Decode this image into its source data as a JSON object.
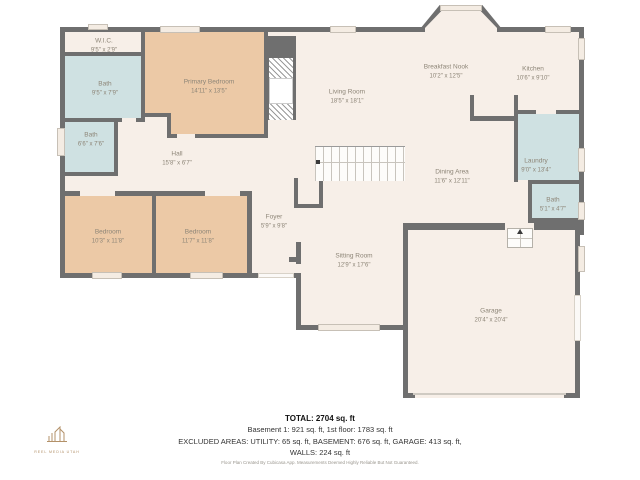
{
  "floorplan": {
    "rooms": [
      {
        "id": "wic",
        "name": "W.I.C.",
        "dims": "9'5\" x 2'9\""
      },
      {
        "id": "bath-upper",
        "name": "Bath",
        "dims": "9'5\" x 7'9\""
      },
      {
        "id": "bath-mid",
        "name": "Bath",
        "dims": "6'6\" x 7'6\""
      },
      {
        "id": "primary-bedroom",
        "name": "Primary Bedroom",
        "dims": "14'11\" x 13'5\""
      },
      {
        "id": "hall",
        "name": "Hall",
        "dims": "15'8\" x 6'7\""
      },
      {
        "id": "living-room",
        "name": "Living Room",
        "dims": "18'5\" x 18'1\""
      },
      {
        "id": "breakfast-nook",
        "name": "Breakfast Nook",
        "dims": "10'2\" x 12'5\""
      },
      {
        "id": "kitchen",
        "name": "Kitchen",
        "dims": "10'6\" x 9'10\""
      },
      {
        "id": "laundry",
        "name": "Laundry",
        "dims": "9'0\" x 13'4\""
      },
      {
        "id": "dining-area",
        "name": "Dining Area",
        "dims": "11'6\" x 12'11\""
      },
      {
        "id": "bath-small",
        "name": "Bath",
        "dims": "5'1\" x 4'7\""
      },
      {
        "id": "bedroom-left",
        "name": "Bedroom",
        "dims": "10'3\" x 11'8\""
      },
      {
        "id": "bedroom-right",
        "name": "Bedroom",
        "dims": "11'7\" x 11'8\""
      },
      {
        "id": "foyer",
        "name": "Foyer",
        "dims": "5'9\" x 9'8\""
      },
      {
        "id": "sitting-room",
        "name": "Sitting Room",
        "dims": "12'9\" x 17'6\""
      },
      {
        "id": "garage",
        "name": "Garage",
        "dims": "20'4\" x 20'4\""
      }
    ],
    "colors": {
      "wall": "#6f6f6f",
      "floor": "#f7efe8",
      "bedroom": "#ecc9a6",
      "bath": "#cfe1e2",
      "label_text": "#8d8577"
    }
  },
  "summary": {
    "total": "TOTAL: 2704 sq. ft",
    "floors": "Basement 1: 921 sq. ft, 1st floor: 1783 sq. ft",
    "excluded": "EXCLUDED AREAS: UTILITY: 65 sq. ft, BASEMENT: 676 sq. ft, GARAGE: 413 sq. ft,",
    "walls": "WALLS: 224 sq. ft",
    "disclaimer": "Floor Plan Created By Cubicasa App. Measurements Deemed Highly Reliable But Not Guaranteed."
  },
  "logo": {
    "text": "REEL MEDIA UTAH",
    "color": "#b39169"
  }
}
